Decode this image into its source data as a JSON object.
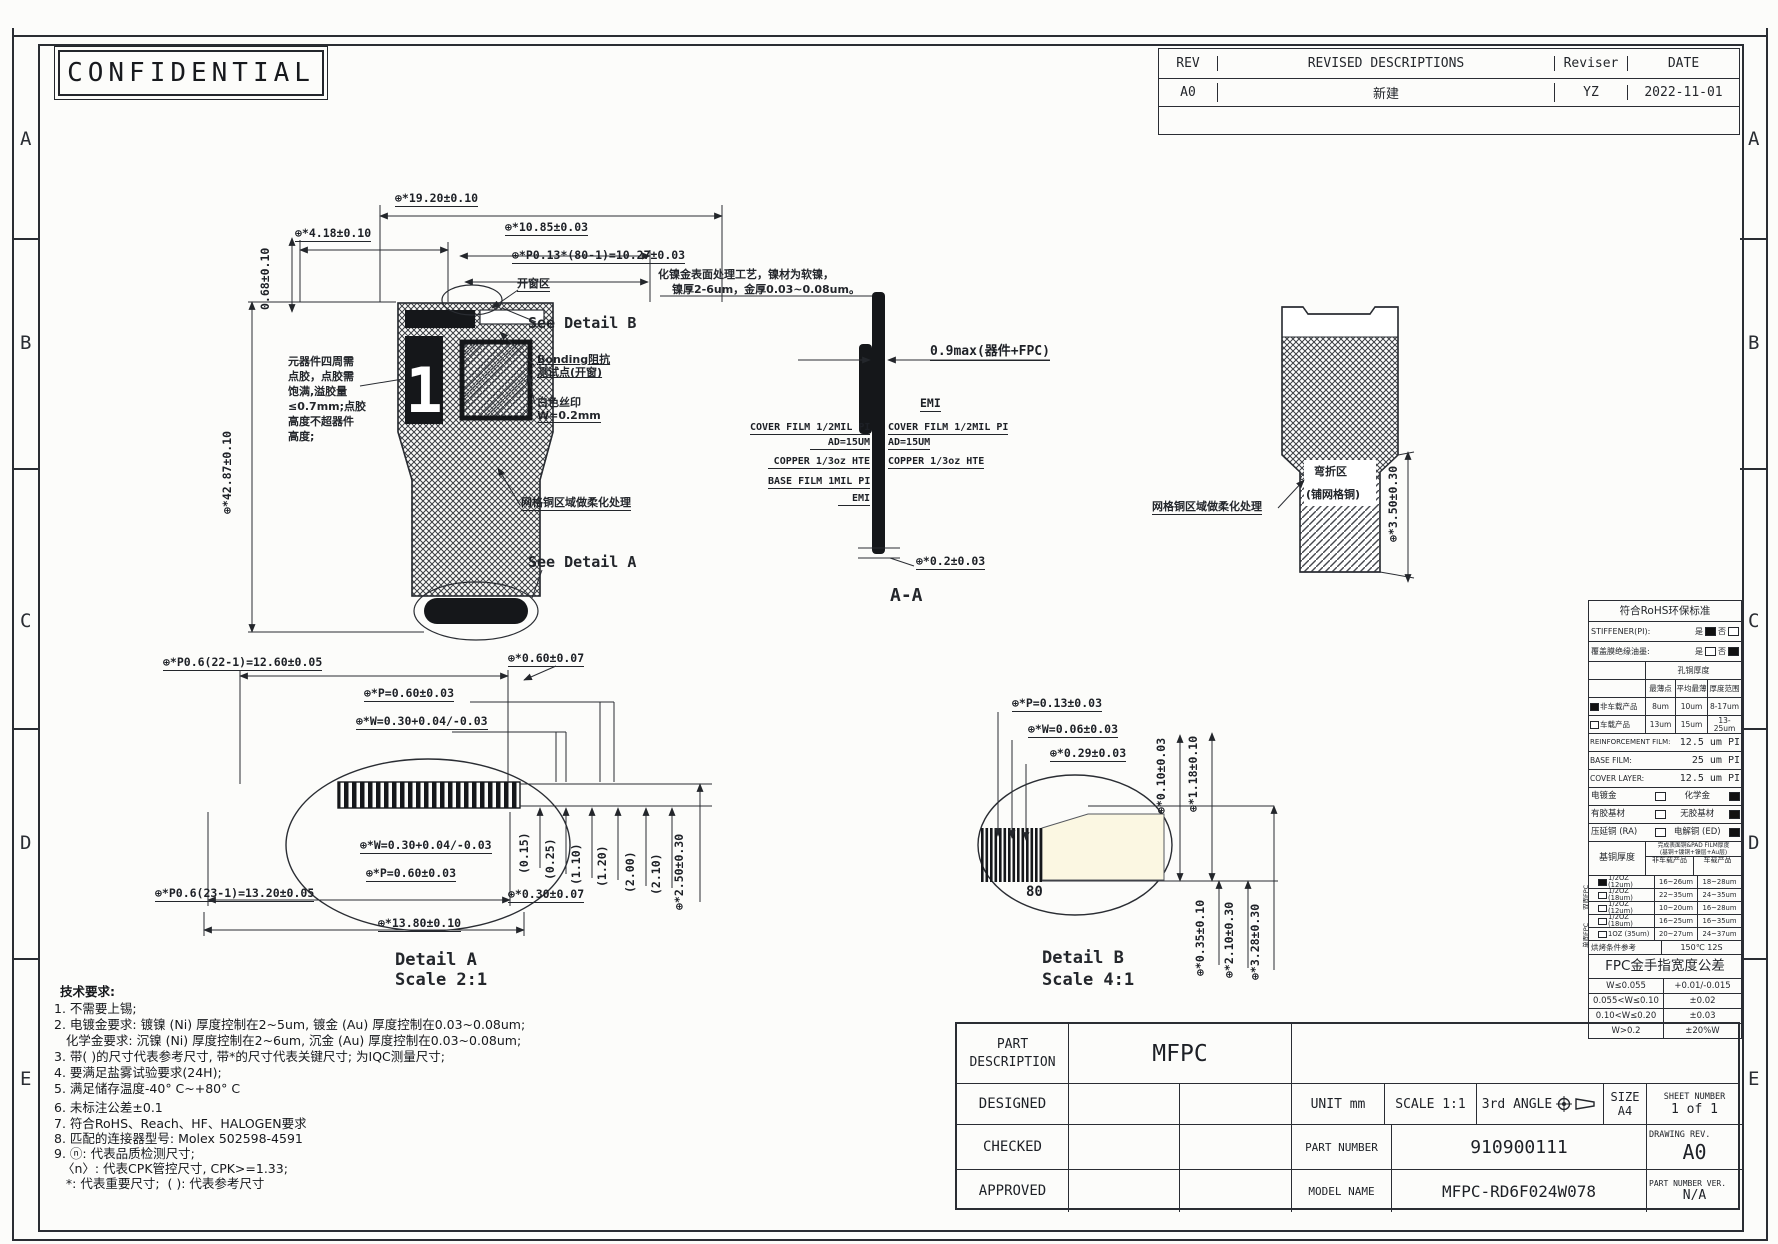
{
  "stamp": {
    "confidential": "CONFIDENTIAL"
  },
  "zones": {
    "letters": [
      "A",
      "B",
      "C",
      "D",
      "E"
    ]
  },
  "revision": {
    "headers": {
      "rev": "REV",
      "desc": "REVISED DESCRIPTIONS",
      "reviser": "Reviser",
      "date": "DATE"
    },
    "row1": {
      "rev": "A0",
      "desc": "新建",
      "reviser": "YZ",
      "date": "2022-11-01"
    }
  },
  "main_view": {
    "dim_19_20": "⊕*19.20±0.10",
    "dim_4_18": "⊕*4.18±0.10",
    "dim_0_68": "0.68±0.10",
    "dim_10_85": "⊕*10.85±0.03",
    "dim_p013": "⊕*P0.13*(80-1)=10.27±0.03",
    "label_window": "开窗区",
    "see_detail_b": "See Detail B",
    "label_bonding": "Bonding阻抗\n测试点(开窗)",
    "label_silk": "白色丝印\nW=0.2mm",
    "note_glue": "元器件四周需\n点胶，点胶需\n饱满,溢胶量\n≤0.7mm;点胶\n高度不超器件\n高度;",
    "dim_42_87": "⊕*42.87±0.10",
    "label_mesh": "网格铜区域做柔化处理",
    "see_detail_a": "See Detail A",
    "component_marking": "1"
  },
  "section_aa": {
    "note_1": "化镍金表面处理工艺，镍材为软镍，",
    "note_2": "镍厚2-6um，金厚0.03~0.08um。",
    "dim_09max": "0.9max(器件+FPC)",
    "emi_top": "EMI",
    "cover_left": "COVER FILM 1/2MIL PI",
    "cover_right": "COVER FILM 1/2MIL PI",
    "ad_left": "AD=15UM",
    "ad_right": "AD=15UM",
    "copper_left": "COPPER 1/3oz HTE",
    "copper_right": "COPPER 1/3oz HTE",
    "base_film": "BASE FILM 1MIL PI",
    "emi_bottom": "EMI",
    "dim_02": "⊕*0.2±0.03",
    "caption": "A-A"
  },
  "right_view": {
    "bend_1": "弯折区",
    "bend_2": "(铺网格铜)",
    "label_mesh": "网格铜区域做柔化处理",
    "dim_3_50": "⊕*3.50±0.30"
  },
  "rohs": {
    "title": "符合RoHS环保标准",
    "stiffener": "STIFFENER(PI):",
    "yes": "是",
    "no": "否",
    "cover_ink": "覆盖膜绝缘油墨:",
    "hole_copper": "孔铜厚度",
    "col_min": "最薄点",
    "col_avg": "平均最薄",
    "col_range": "厚度范围",
    "row_non_auto": "非车载产品",
    "row_auto": "车载产品",
    "na_min": "8um",
    "na_avg": "10um",
    "na_range": "8-17um",
    "a_min": "13um",
    "a_avg": "15um",
    "a_range": "13-25um",
    "reinforcement": "REINFORCEMENT FILM:",
    "reinforcement_v": "12.5 um PI",
    "base_film": "BASE FILM:",
    "base_film_v": "25  um PI",
    "cover_layer": "COVER LAYER:",
    "cover_layer_v": "12.5 um PI",
    "plated_gold": "电镀金",
    "chem_gold": "化学金",
    "adhesive": "有胶基材",
    "adhesiveless": "无胶基材",
    "ra_copper": "压延铜 (RA)",
    "ed_copper": "电解铜 (ED)",
    "base_copper": "基铜厚度",
    "finish_title_1": "完成表面铜&PAD FILM厚度",
    "finish_title_2": "(基铜+镀铜+镍层+Au层)",
    "col_non_auto": "非车载产品",
    "col_auto": "车载产品",
    "group_double": "双面FPC",
    "group_single": "单面FPC",
    "copper_rows": [
      {
        "t": "1/2OZ (12um)",
        "a": "16~26um",
        "b": "18~28um"
      },
      {
        "t": "1/2OZ (18um)",
        "a": "22~35um",
        "b": "24~35um"
      },
      {
        "t": "1/2OZ (12um)",
        "a": "10~20um",
        "b": "16~28um"
      },
      {
        "t": "1/2OZ (18um)",
        "a": "16~25um",
        "b": "16~35um"
      },
      {
        "t": "1OZ (35um)",
        "a": "20~27um",
        "b": "24~37um"
      }
    ],
    "bake": "烘烤条件参考",
    "bake_v": "150℃ 12S",
    "finger_title": "FPC金手指宽度公差",
    "finger_rows": [
      {
        "t": "W≤0.055",
        "v": "+0.01/-0.015"
      },
      {
        "t": "0.055<W≤0.10",
        "v": "±0.02"
      },
      {
        "t": "0.10<W≤0.20",
        "v": "±0.03"
      },
      {
        "t": "W>0.2",
        "v": "±20%W"
      }
    ]
  },
  "detail_a": {
    "dim_p06_22": "⊕*P0.6(22-1)=12.60±0.05",
    "dim_060_007": "⊕*0.60±0.07",
    "dim_p_060": "⊕*P=0.60±0.03",
    "dim_w_030": "⊕*W=0.30+0.04/-0.03",
    "dim_w_030_b": "⊕*W=0.30+0.04/-0.03",
    "dim_p_060_b": "⊕*P=0.60±0.03",
    "dim_p06_23": "⊕*P0.6(23-1)=13.20±0.05",
    "dim_030_007": "⊕*0.30±0.07",
    "dim_13_80": "⊕*13.80±0.10",
    "vd0": "(0.15)",
    "vd1": "(0.25)",
    "vd2": "(1.10)",
    "vd3": "(1.20)",
    "vd4": "(2.00)",
    "vd5": "(2.10)",
    "dim_2_50": "⊕*2.50±0.30",
    "caption_1": "Detail A",
    "caption_2": "Scale 2:1"
  },
  "detail_b": {
    "dim_p_013": "⊕*P=0.13±0.03",
    "dim_w_006": "⊕*W=0.06±0.03",
    "dim_029": "⊕*0.29±0.03",
    "dim_010": "⊕*0.10±0.03",
    "dim_118": "⊕*1.18±0.10",
    "label_80": "80",
    "dim_035": "⊕*0.35±0.10",
    "dim_210": "⊕*2.10±0.30",
    "dim_328": "⊕*3.28±0.30",
    "caption_1": "Detail B",
    "caption_2": "Scale 4:1"
  },
  "notes": {
    "title": "技术要求:",
    "lines": [
      "1. 不需要上锡;",
      "2. 电镀金要求: 镀镍 (Ni) 厚度控制在2~5um, 镀金 (Au) 厚度控制在0.03~0.08um;",
      "   化学金要求: 沉镍 (Ni) 厚度控制在2~6um, 沉金 (Au) 厚度控制在0.03~0.08um;",
      "3. 带( )的尺寸代表参考尺寸, 带*的尺寸代表关键尺寸; 为IQC测量尺寸;",
      "4. 要满足盐雾试验要求(24H);",
      "5. 满足储存温度-40° C~+80° C",
      "6. 未标注公差±0.1",
      "7. 符合RoHS、Reach、HF、HALOGEN要求",
      "8. 匹配的连接器型号: Molex 502598-4591",
      "9. ⓝ: 代表品质检测尺寸;",
      "  〈n〉: 代表CPK管控尺寸, CPK>=1.33;",
      "   *: 代表重要尺寸;  ( ): 代表参考尺寸"
    ]
  },
  "title_block": {
    "pd1": "PART",
    "pd2": "DESCRIPTION",
    "mfpc": "MFPC",
    "designed": "DESIGNED",
    "checked": "CHECKED",
    "approved": "APPROVED",
    "unit": "UNIT  mm",
    "scale": "SCALE  1:1",
    "angle": "3rd ANGLE",
    "size_label": "SIZE",
    "size_value": "A4",
    "sheet_label": "SHEET NUMBER",
    "sheet_value": "1 of 1",
    "part_number_label": "PART NUMBER",
    "part_number_value": "910900111",
    "drawing_rev_label": "DRAWING REV.",
    "drawing_rev_value": "A0",
    "model_name_label": "MODEL NAME",
    "model_name_value": "MFPC-RD6F024W078",
    "part_number_ver_label": "PART NUMBER VER.",
    "part_number_ver_value": "N/A"
  }
}
